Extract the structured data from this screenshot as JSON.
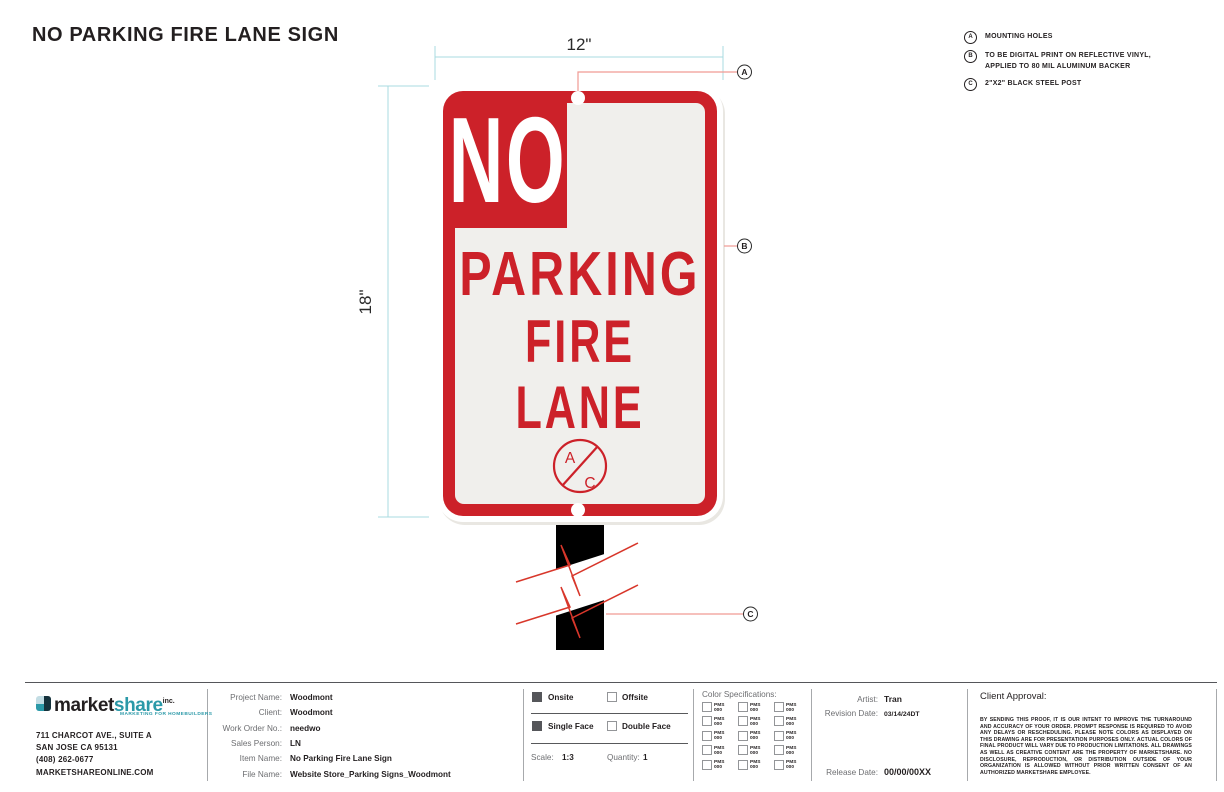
{
  "title": "NO PARKING FIRE LANE SIGN",
  "notes": [
    {
      "key": "A",
      "lines": [
        "MOUNTING HOLES"
      ]
    },
    {
      "key": "B",
      "lines": [
        "TO BE DIGITAL PRINT ON REFLECTIVE VINYL,",
        "APPLIED TO 80 MIL ALUMINUM BACKER"
      ]
    },
    {
      "key": "C",
      "lines": [
        "2\"X2\" BLACK STEEL POST"
      ]
    }
  ],
  "drawing": {
    "width_label": "12\"",
    "height_label": "18\"",
    "sign_text": {
      "no": "NO",
      "line2": "PARKING",
      "line3": "FIRE",
      "line4": "LANE"
    },
    "badge": {
      "top": "A",
      "bottom": "C"
    },
    "callouts": {
      "a": "A",
      "b": "B",
      "c": "C"
    },
    "colors": {
      "sign_red": "#cc2129",
      "sign_face": "#f0efec",
      "post_black": "#000000",
      "dimension_line": "#a9dbe1",
      "callout_line": "#f19a93",
      "break_line": "#d8372b"
    }
  },
  "footer": {
    "company": {
      "logo_market": "market",
      "logo_share": "share",
      "logo_inc": "inc.",
      "tagline": "MARKETING FOR HOMEBUILDERS",
      "address1": "711 CHARCOT AVE., SUITE A",
      "address2": "SAN JOSE CA 95131",
      "phone": "(408) 262-0677",
      "website": "MARKETSHAREONLINE.COM",
      "accent_teal": "#2b99a8"
    },
    "project_rows": [
      {
        "label": "Project Name:",
        "value": "Woodmont"
      },
      {
        "label": "Client:",
        "value": "Woodmont"
      },
      {
        "label": "Work Order No.:",
        "value": "needwo"
      },
      {
        "label": "Sales Person:",
        "value": "LN"
      },
      {
        "label": "Item Name:",
        "value": "No Parking Fire Lane Sign"
      },
      {
        "label": "File Name:",
        "value": "Website Store_Parking Signs_Woodmont"
      }
    ],
    "options": {
      "onsite": {
        "label": "Onsite",
        "checked": true
      },
      "offsite": {
        "label": "Offsite",
        "checked": false
      },
      "single_face": {
        "label": "Single Face",
        "checked": true
      },
      "double_face": {
        "label": "Double Face",
        "checked": false
      },
      "scale_label": "Scale:",
      "scale_value": "1:3",
      "quantity_label": "Quantity:",
      "quantity_value": "1"
    },
    "color_specs": {
      "title": "Color Specifications:",
      "cell_line1": "PMS",
      "cell_line2": "000",
      "cells": 15
    },
    "credits": {
      "artist_label": "Artist:",
      "artist": "Tran",
      "revision_label": "Revision Date:",
      "revision": "03/14/24DT",
      "release_label": "Release Date:",
      "release": "00/00/00XX"
    },
    "approval": {
      "title": "Client Approval:",
      "disclaimer": "BY SENDING THIS PROOF, IT IS OUR INTENT TO IMPROVE THE TURNAROUND AND ACCURACY OF YOUR ORDER. PROMPT RESPONSE IS REQUIRED TO AVOID ANY DELAYS OR RESCHEDULING. PLEASE NOTE COLORS AS DISPLAYED ON THIS DRAWING ARE FOR PRESENTATION PURPOSES ONLY. ACTUAL COLORS OF FINAL PRODUCT WILL VARY DUE TO PRODUCTION LIMITATIONS. ALL DRAWINGS AS WELL AS CREATIVE CONTENT ARE THE PROPERTY OF MARKETSHARE. NO DISCLOSURE, REPRODUCTION, OR DISTRIBUTION OUTSIDE OF YOUR ORGANIZATION IS ALLOWED WITHOUT PRIOR WRITTEN CONSENT OF AN AUTHORIZED MARKETSHARE EMPLOYEE."
    }
  }
}
